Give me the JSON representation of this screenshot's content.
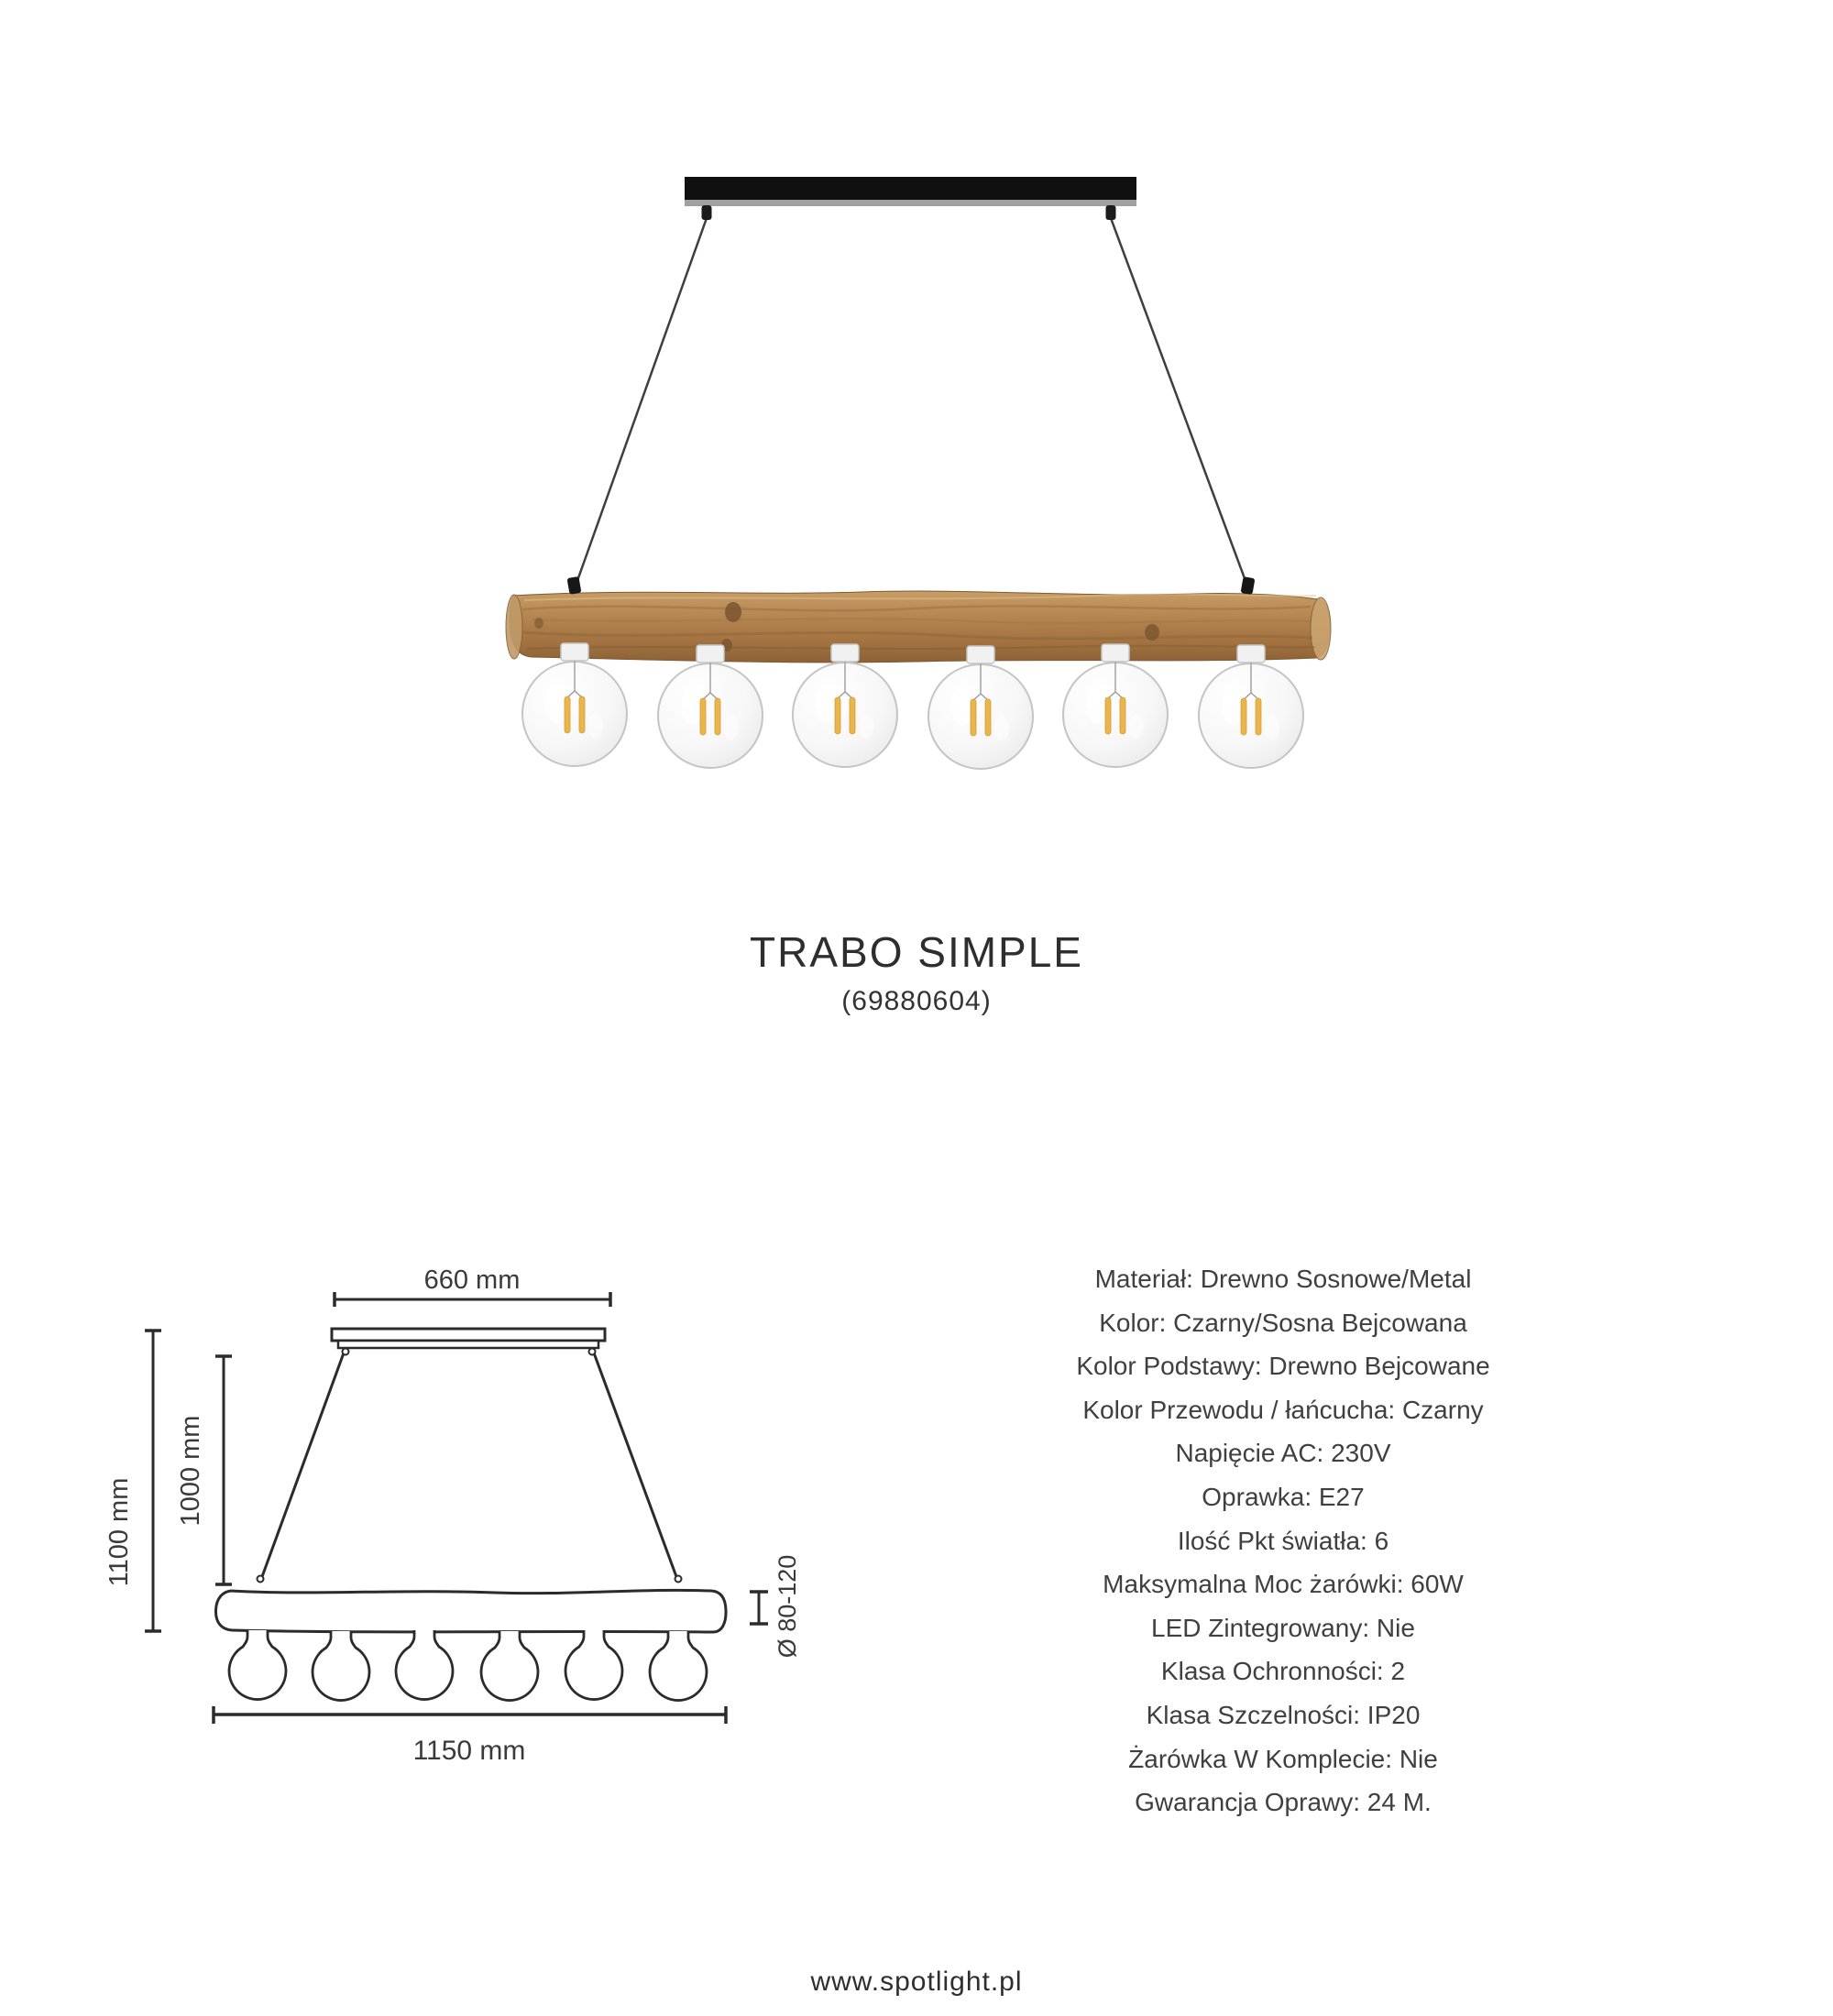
{
  "product": {
    "title": "TRABO SIMPLE",
    "code": "(69880604)"
  },
  "photo": {
    "bulb_count": 6,
    "colors": {
      "canopy_black": "#101010",
      "canopy_lip_gray": "#a0a0a0",
      "cable_dark": "#3e3e3e",
      "wood_light": "#c89d66",
      "wood_mid": "#b2834f",
      "wood_dark": "#8b6136",
      "glass_stroke": "#c4c4c4",
      "filament_amber": "#e9b54f"
    }
  },
  "drawing": {
    "dim_width_top": "660 mm",
    "dim_height_total": "1100 mm",
    "dim_height_cable": "1000 mm",
    "dim_diameter": "Ø 80-120",
    "dim_length": "1150 mm",
    "line_color": "#2b2b2b"
  },
  "specs": {
    "items": [
      "Materiał: Drewno Sosnowe/Metal",
      "Kolor: Czarny/Sosna Bejcowana",
      "Kolor Podstawy: Drewno Bejcowane",
      "Kolor Przewodu / łańcucha: Czarny",
      "Napięcie AC: 230V",
      "Oprawka: E27",
      "Ilość Pkt światła: 6",
      "Maksymalna Moc żarówki: 60W",
      "LED Zintegrowany: Nie",
      "Klasa Ochronności: 2",
      "Klasa Szczelności: IP20",
      "Żarówka W Komplecie: Nie",
      "Gwarancja Oprawy: 24 M."
    ]
  },
  "footer": {
    "url": "www.spotlight.pl"
  }
}
